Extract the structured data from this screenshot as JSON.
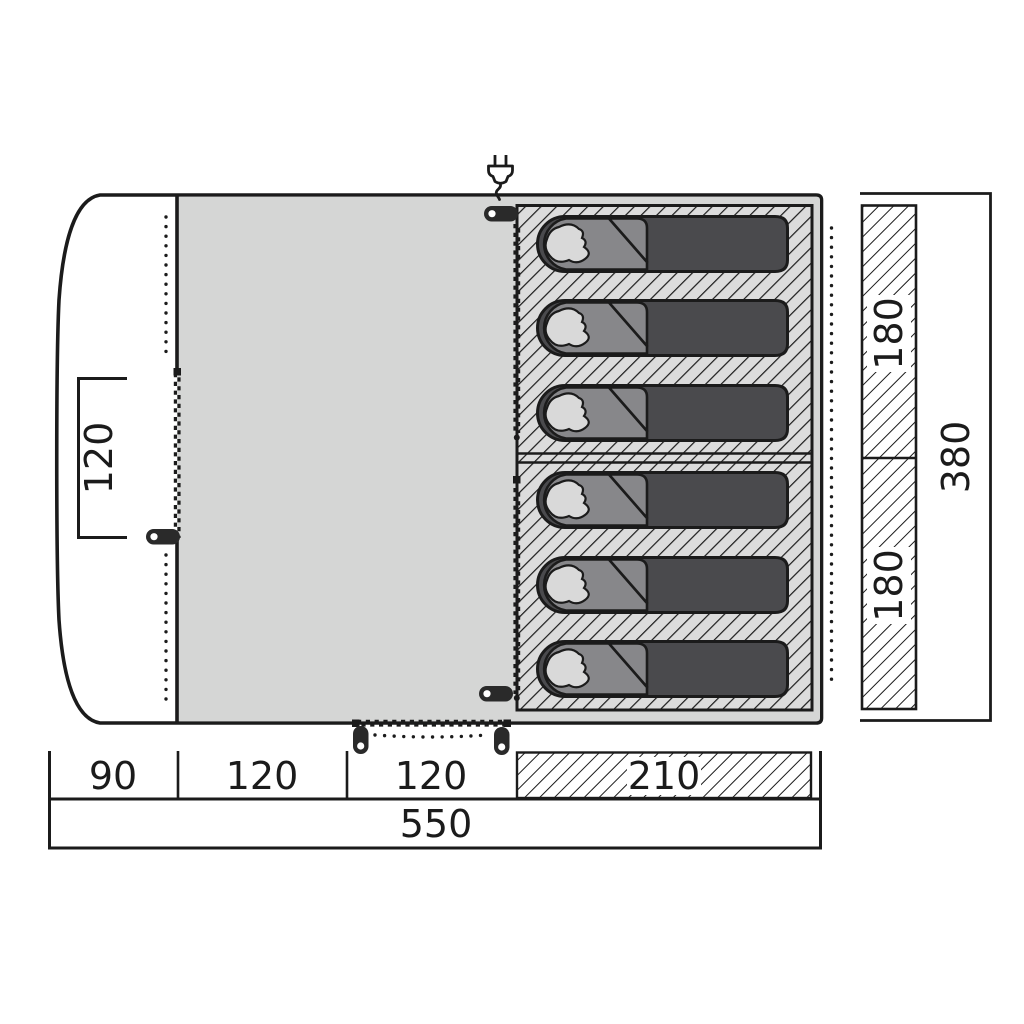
{
  "diagram": {
    "kind": "tent floor plan",
    "colors": {
      "outline": "#1b1b1b",
      "living_area_fill": "#d5d6d5",
      "sleeping_hatch_bg": "#dcdcdc",
      "dimension_hatch_bg": "#ffffff",
      "bag_body": "#4a4a4d",
      "bag_hood": "#87878a",
      "bag_head": "#d9d9d9",
      "zipper_pull": "#2a2a2a",
      "background": "#ffffff"
    },
    "icons": {
      "power": "power-plug-icon",
      "pull": "zipper-pull-icon",
      "zipper": "zipper-teeth",
      "bag": "sleeping-bag"
    }
  },
  "labels": {
    "left_door_width": "120",
    "bottom_row": [
      "90",
      "120",
      "120",
      "210"
    ],
    "bottom_total": "550",
    "right_sections": [
      "180",
      "180"
    ],
    "right_total": "380"
  },
  "sleeping_area": {
    "bag_count": 6,
    "bag_x": 535,
    "bag_y": [
      215,
      299,
      384,
      471,
      556,
      640
    ]
  }
}
